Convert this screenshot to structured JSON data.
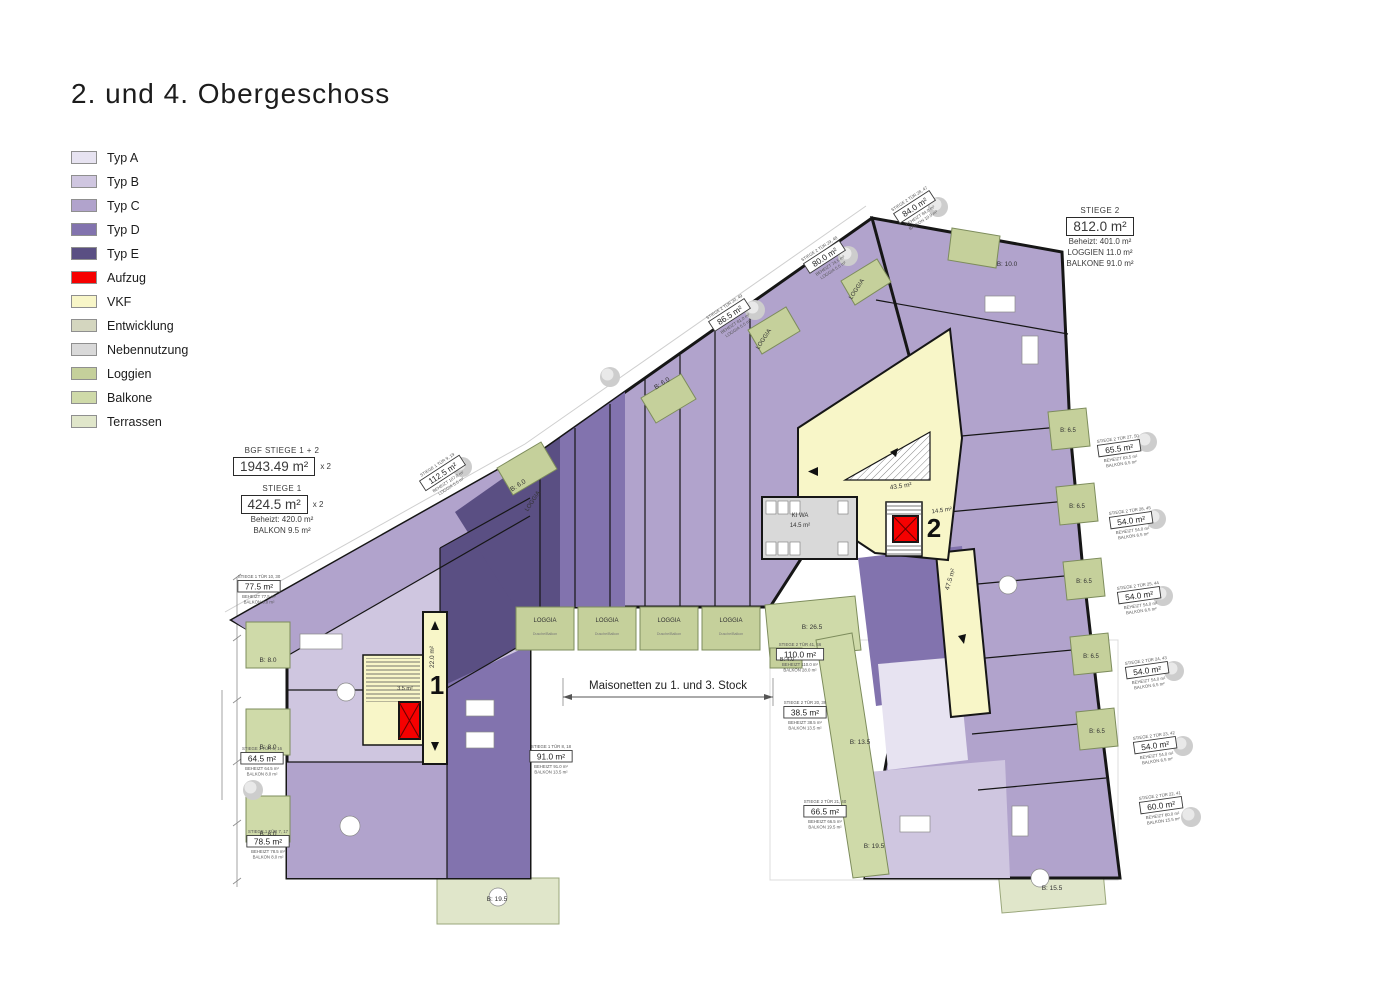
{
  "title": "2. und 4. Obergeschoss",
  "colors": {
    "typ_a": "#e7e3f1",
    "typ_b": "#cfc6e0",
    "typ_c": "#b1a3cc",
    "typ_d": "#8273ae",
    "typ_e": "#5a4f83",
    "aufzug": "#f60000",
    "vkf": "#f8f6c8",
    "entwicklung": "#d4d6bf",
    "nebennutzung": "#d9d9d9",
    "loggien": "#c5d09b",
    "balkone": "#cfdaa9",
    "terrassen": "#e0e6ca",
    "wall": "#161616"
  },
  "legend": {
    "items": [
      {
        "label": "Typ A",
        "color_key": "typ_a"
      },
      {
        "label": "Typ B",
        "color_key": "typ_b"
      },
      {
        "label": "Typ C",
        "color_key": "typ_c"
      },
      {
        "label": "Typ D",
        "color_key": "typ_d"
      },
      {
        "label": "Typ E",
        "color_key": "typ_e"
      },
      {
        "label": "Aufzug",
        "color_key": "aufzug"
      },
      {
        "label": "VKF",
        "color_key": "vkf"
      },
      {
        "label": "Entwicklung",
        "color_key": "entwicklung"
      },
      {
        "label": "Nebennutzung",
        "color_key": "nebennutzung"
      },
      {
        "label": "Loggien",
        "color_key": "loggien"
      },
      {
        "label": "Balkone",
        "color_key": "balkone"
      },
      {
        "label": "Terrassen",
        "color_key": "terrassen"
      }
    ]
  },
  "info_boxes": {
    "bgf": {
      "heading": "BGF STIEGE 1 + 2",
      "value": "1943.49 m²",
      "multiplier": "x 2"
    },
    "stiege1": {
      "heading": "STIEGE 1",
      "value": "424.5 m²",
      "multiplier": "x 2",
      "beheizt": "Beheizt: 420.0 m²",
      "balkon": "BALKON 9.5 m²"
    },
    "stiege2": {
      "heading": "STIEGE 2",
      "value": "812.0 m²",
      "beheizt": "Beheizt: 401.0 m²",
      "loggien": "LOGGIEN  11.0 m²",
      "balkone": "BALKONE 91.0 m²"
    }
  },
  "plan": {
    "note": "Maisonetten zu 1. und 3. Stock",
    "markers": [
      {
        "text": "1",
        "x": 437,
        "y": 694
      },
      {
        "text": "2",
        "x": 934,
        "y": 537
      }
    ],
    "unit_labels": [
      {
        "title": "STIEGE 1 TÜR 10, 30",
        "area": "77.5 m²",
        "lines": [
          "BEHEIZT 77.5 m²",
          "BALKON 8.0 m²"
        ],
        "x": 259,
        "y": 578,
        "r": 0
      },
      {
        "title": "STIEGE 1 TÜR 6, 16",
        "area": "64.5 m²",
        "lines": [
          "BEHEIZT 64.5 m²",
          "BALKON 8.0 m²"
        ],
        "x": 262,
        "y": 750,
        "r": 0
      },
      {
        "title": "STIEGE 1 TÜR 7, 17",
        "area": "78.5 m²",
        "lines": [
          "BEHEIZT 78.5 m²",
          "BALKON 8.0 m²"
        ],
        "x": 268,
        "y": 833,
        "r": 0
      },
      {
        "title": "STIEGE 1 TÜR 8, 18",
        "area": "91.0 m²",
        "lines": [
          "BEHEIZT 91.0 m²",
          "BALKON 13.5 m²"
        ],
        "x": 551,
        "y": 748,
        "r": 0
      },
      {
        "title": "STIEGE 1 TÜR 9, 19",
        "area": "112.5 m²",
        "lines": [
          "BEHEIZT 107.0 m²",
          "LOGGIA 5.5 m²"
        ],
        "x": 438,
        "y": 466,
        "r": -33
      },
      {
        "title": "STIEGE 2 TÜR 30, 49",
        "area": "86.5 m²",
        "lines": [
          "BEHEIZT 81.0 m²",
          "LOGGIA 5.5 m²"
        ],
        "x": 725,
        "y": 308,
        "r": -33
      },
      {
        "title": "STIEGE 2 TÜR 29, 48",
        "area": "80.0 m²",
        "lines": [
          "BEHEIZT 74.5 m²",
          "LOGGIA 5.5 m²"
        ],
        "x": 820,
        "y": 250,
        "r": -33
      },
      {
        "title": "STIEGE 2 TÜR 28, 47",
        "area": "84.0 m²",
        "lines": [
          "BEHEIZT 84.0 m²",
          "BALKON 10.0 m²"
        ],
        "x": 910,
        "y": 200,
        "r": -33
      },
      {
        "title": "STIEGE 2 TÜR 27, 50",
        "area": "65.5 m²",
        "lines": [
          "BEHEIZT 63.5 m²",
          "BALKON 6.5 m²"
        ],
        "x": 1118,
        "y": 440,
        "r": -8
      },
      {
        "title": "STIEGE 2 TÜR 26, 45",
        "area": "54.0 m²",
        "lines": [
          "BEHEIZT 54.0 m²",
          "BALKON 6.5 m²"
        ],
        "x": 1130,
        "y": 512,
        "r": -8
      },
      {
        "title": "STIEGE 2 TÜR 25, 44",
        "area": "54.0 m²",
        "lines": [
          "BEHEIZT 54.0 m²",
          "BALKON 6.5 m²"
        ],
        "x": 1138,
        "y": 587,
        "r": -8
      },
      {
        "title": "STIEGE 2 TÜR 24, 43",
        "area": "54.0 m²",
        "lines": [
          "BEHEIZT 54.0 m²",
          "BALKON 6.5 m²"
        ],
        "x": 1146,
        "y": 662,
        "r": -8
      },
      {
        "title": "STIEGE 2 TÜR 23, 42",
        "area": "54.0 m²",
        "lines": [
          "BEHEIZT 54.0 m²",
          "BALKON 6.5 m²"
        ],
        "x": 1154,
        "y": 737,
        "r": -8
      },
      {
        "title": "STIEGE 2 TÜR 22, 41",
        "area": "60.0 m²",
        "lines": [
          "BEHEIZT 60.0 m²",
          "BALKON 15.5 m²"
        ],
        "x": 1160,
        "y": 797,
        "r": -8
      },
      {
        "title": "STIEGE 2 TÜR 41, 46",
        "area": "110.0 m²",
        "lines": [
          "BEHEIZT 110.0 m²",
          "BALKON 28.0 m²"
        ],
        "x": 800,
        "y": 646,
        "r": 0
      },
      {
        "title": "STIEGE 2 TÜR 20, 39",
        "area": "38.5 m²",
        "lines": [
          "BEHEIZT 38.5 m²",
          "BALKON 13.5 m²"
        ],
        "x": 805,
        "y": 704,
        "r": 0
      },
      {
        "title": "STIEGE 2 TÜR 21, 40",
        "area": "66.5 m²",
        "lines": [
          "BEHEIZT 66.5 m²",
          "BALKON 19.5 m²"
        ],
        "x": 825,
        "y": 803,
        "r": 0
      }
    ],
    "area_labels": [
      {
        "text": "B: 8.0",
        "x": 268,
        "y": 662,
        "s": 6.5
      },
      {
        "text": "B: 8.0",
        "x": 268,
        "y": 749,
        "s": 6.5
      },
      {
        "text": "B: 8.0",
        "x": 268,
        "y": 836,
        "s": 6.5
      },
      {
        "text": "B: 19.5",
        "x": 497,
        "y": 901,
        "s": 6.5
      },
      {
        "text": "B: 6.0",
        "x": 519,
        "y": 487,
        "s": 6.5,
        "r": -33
      },
      {
        "text": "B: 6.0",
        "x": 663,
        "y": 385,
        "s": 6.5,
        "r": -33
      },
      {
        "text": "LOGGIA",
        "x": 534,
        "y": 502,
        "s": 6,
        "r": -57
      },
      {
        "text": "LOGGIA",
        "x": 765,
        "y": 340,
        "s": 6,
        "r": -57
      },
      {
        "text": "LOGGIA",
        "x": 858,
        "y": 290,
        "s": 6,
        "r": -57
      },
      {
        "text": "B: 10.0",
        "x": 1007,
        "y": 266,
        "s": 6.5
      },
      {
        "text": "B: 26.5",
        "x": 812,
        "y": 629,
        "s": 6.5
      },
      {
        "text": "B: 4.0",
        "x": 787,
        "y": 661,
        "s": 5.5
      },
      {
        "text": "B: 13.5",
        "x": 860,
        "y": 744,
        "s": 6.5
      },
      {
        "text": "B: 19.5",
        "x": 874,
        "y": 848,
        "s": 6.5
      },
      {
        "text": "B: 15.5",
        "x": 1052,
        "y": 890,
        "s": 6.5
      },
      {
        "text": "B: 6.5",
        "x": 1068,
        "y": 432,
        "s": 6
      },
      {
        "text": "B: 6.5",
        "x": 1077,
        "y": 508,
        "s": 6
      },
      {
        "text": "B: 6.5",
        "x": 1084,
        "y": 583,
        "s": 6
      },
      {
        "text": "B: 6.5",
        "x": 1091,
        "y": 658,
        "s": 6
      },
      {
        "text": "B: 6.5",
        "x": 1097,
        "y": 733,
        "s": 6
      },
      {
        "text": "22.0 m²",
        "x": 434,
        "y": 657,
        "s": 6.5,
        "r": -90
      },
      {
        "text": "3.5 m²",
        "x": 405,
        "y": 690,
        "s": 5.5
      },
      {
        "text": "43.5 m²",
        "x": 901,
        "y": 488,
        "s": 6.5,
        "r": -8
      },
      {
        "text": "14.5 m²",
        "x": 942,
        "y": 512,
        "s": 6,
        "r": -8
      },
      {
        "text": "47.5 m²",
        "x": 952,
        "y": 580,
        "s": 6.5,
        "r": -73
      },
      {
        "text": "KI WA",
        "x": 800,
        "y": 517,
        "s": 6
      },
      {
        "text": "14.5 m²",
        "x": 800,
        "y": 527,
        "s": 6
      }
    ],
    "loggia_band": {
      "x0": 516,
      "y": 607,
      "w": 58,
      "gap": 4,
      "h": 43,
      "cells": [
        {
          "label": "LOGGIA",
          "sub": "Dusche/Balkon"
        },
        {
          "label": "LOGGIA",
          "sub": "Dusche/Balkon"
        },
        {
          "label": "LOGGIA",
          "sub": "Dusche/Balkon"
        },
        {
          "label": "LOGGIA",
          "sub": "Dusche/Balkon"
        }
      ]
    },
    "trees": [
      [
        938,
        207
      ],
      [
        848,
        256
      ],
      [
        755,
        310
      ],
      [
        610,
        377
      ],
      [
        462,
        467
      ],
      [
        253,
        790
      ],
      [
        1147,
        442
      ],
      [
        1156,
        519
      ],
      [
        1163,
        596
      ],
      [
        1174,
        671
      ],
      [
        1183,
        746
      ],
      [
        1191,
        817
      ]
    ]
  }
}
